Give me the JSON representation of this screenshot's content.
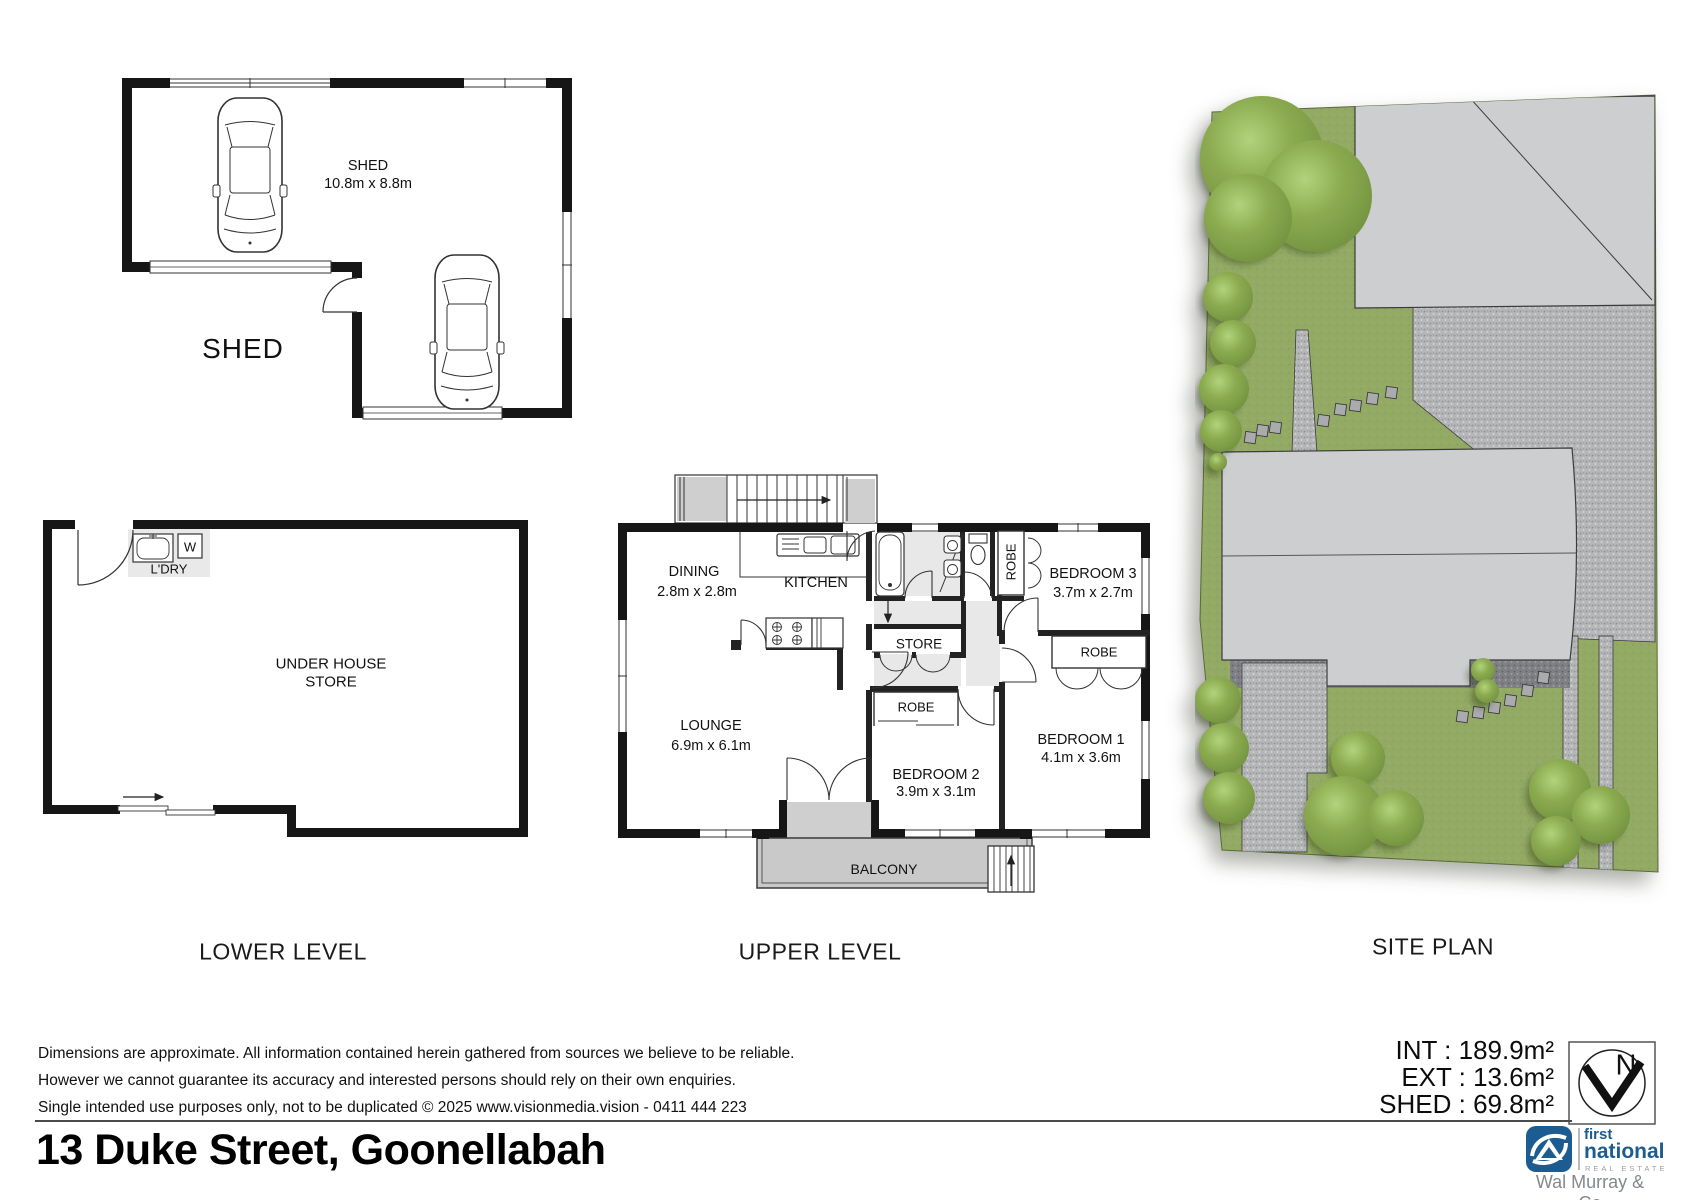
{
  "shed_plan": {
    "room_label": "SHED",
    "room_dims": "10.8m x 8.8m",
    "plan_label": "SHED"
  },
  "lower_plan": {
    "laundry_label": "L'DRY",
    "washer_label": "W",
    "store_label_line1": "UNDER HOUSE",
    "store_label_line2": "STORE",
    "level_label": "LOWER LEVEL"
  },
  "upper_plan": {
    "level_label": "UPPER LEVEL",
    "dining_name": "DINING",
    "dining_dims": "2.8m x 2.8m",
    "kitchen_name": "KITCHEN",
    "lounge_name": "LOUNGE",
    "lounge_dims": "6.9m x 6.1m",
    "store_name": "STORE",
    "robe_bed3": "ROBE",
    "bed3_name": "BEDROOM 3",
    "bed3_dims": "3.7m x 2.7m",
    "robe_bed1": "ROBE",
    "bed1_name": "BEDROOM 1",
    "bed1_dims": "4.1m x 3.6m",
    "robe_bed2": "ROBE",
    "bed2_name": "BEDROOM 2",
    "bed2_dims": "3.9m x 3.1m",
    "balcony_name": "BALCONY"
  },
  "site_plan": {
    "level_label": "SITE PLAN"
  },
  "areas": {
    "int": "INT : 189.9m²",
    "ext": "EXT : 13.6m²",
    "shed": "SHED : 69.8m²"
  },
  "north": {
    "letter": "N"
  },
  "footer": {
    "disclaimer_line1": "Dimensions are approximate. All information contained herein gathered from sources we believe to be reliable.",
    "disclaimer_line2": "However we cannot guarantee its accuracy and interested persons should rely on their own enquiries.",
    "disclaimer_line3": "Single intended use purposes only, not to be duplicated © 2025 www.visionmedia.vision - 0411 444 223",
    "address": "13 Duke Street, Goonellabah"
  },
  "logo": {
    "brand_line1": "first",
    "brand_line2": "national",
    "brand_line3": "REAL ESTATE",
    "agency": "Wal Murray & Co"
  },
  "colors": {
    "wall": "#161616",
    "site_green": "#93aa64",
    "gravel": "#b5b6b8",
    "building_gray": "#cdced0",
    "logo_blue": "#1d5c90"
  }
}
